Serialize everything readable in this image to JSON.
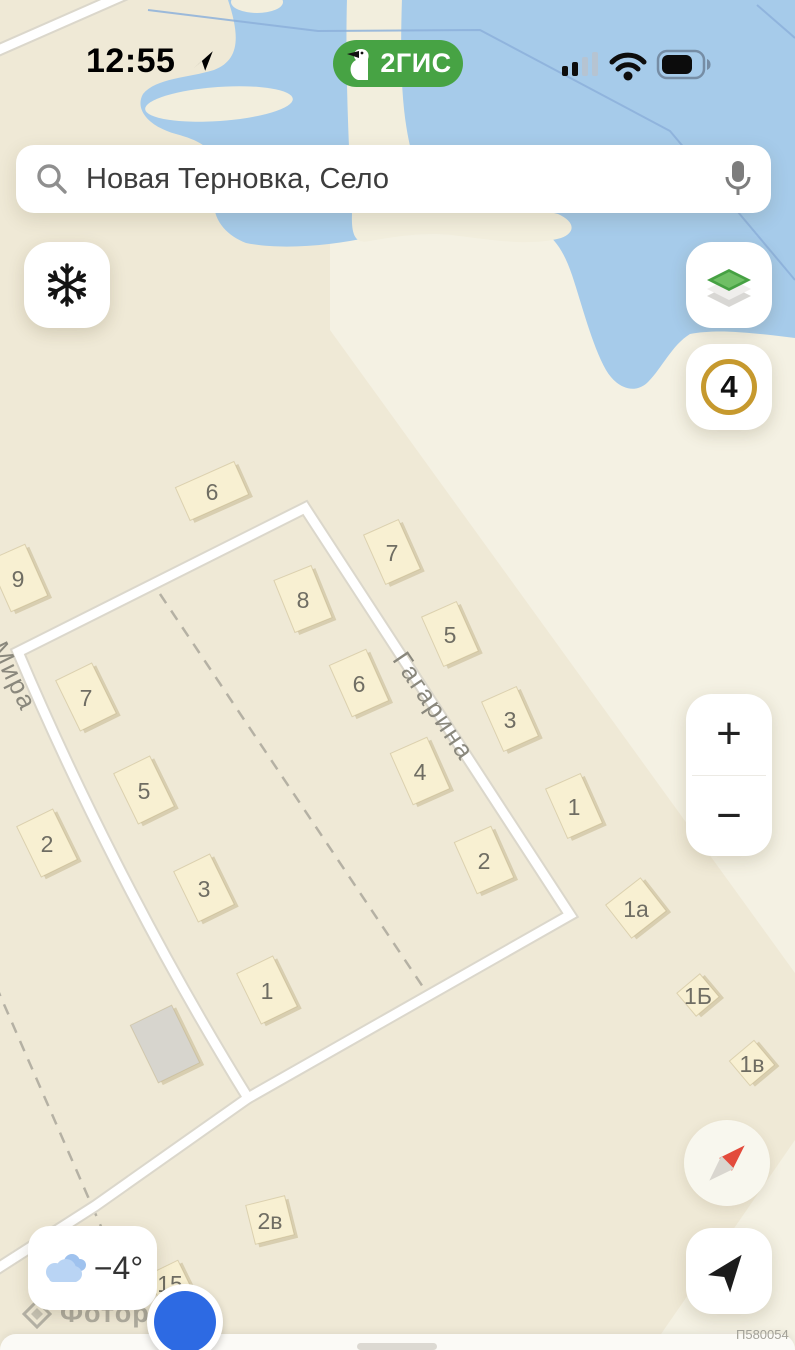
{
  "status_bar": {
    "time": "12:55"
  },
  "branding": {
    "label": "2ГИС"
  },
  "search": {
    "query": "Новая Терновка, Село"
  },
  "map_controls": {
    "floor_badge": "4",
    "zoom_in": "+",
    "zoom_out": "−"
  },
  "weather": {
    "temperature": "−4°"
  },
  "watermark": {
    "brand": "Фоториэлт"
  },
  "footer": {
    "code": "П580054"
  },
  "colors": {
    "brand_green": "#47a344",
    "water": "#a6cbea",
    "land": "#efe9d6",
    "building": "#f8f0d2",
    "floor_ring_gold": "#c6992e",
    "marker_blue": "#2d6ae3"
  },
  "map": {
    "street_labels": [
      {
        "text": "Мира",
        "x": 14,
        "y": 676,
        "angle": 64
      },
      {
        "text": "Гагарина",
        "x": 434,
        "y": 706,
        "angle": 56
      }
    ],
    "buildings": [
      {
        "label": "6",
        "x": 212,
        "y": 491,
        "w": 64,
        "h": 36,
        "a": -24
      },
      {
        "label": "9",
        "x": 18,
        "y": 578,
        "w": 40,
        "h": 56,
        "a": -24
      },
      {
        "label": "7",
        "x": 392,
        "y": 552,
        "w": 38,
        "h": 54,
        "a": -24
      },
      {
        "label": "8",
        "x": 303,
        "y": 599,
        "w": 40,
        "h": 56,
        "a": -22
      },
      {
        "label": "5",
        "x": 450,
        "y": 634,
        "w": 38,
        "h": 54,
        "a": -24
      },
      {
        "label": "7",
        "x": 86,
        "y": 697,
        "w": 40,
        "h": 56,
        "a": -26
      },
      {
        "label": "6",
        "x": 359,
        "y": 683,
        "w": 40,
        "h": 56,
        "a": -24
      },
      {
        "label": "3",
        "x": 510,
        "y": 719,
        "w": 38,
        "h": 54,
        "a": -24
      },
      {
        "label": "4",
        "x": 420,
        "y": 771,
        "w": 40,
        "h": 56,
        "a": -24
      },
      {
        "label": "5",
        "x": 144,
        "y": 790,
        "w": 40,
        "h": 56,
        "a": -26
      },
      {
        "label": "1",
        "x": 574,
        "y": 806,
        "w": 38,
        "h": 54,
        "a": -24
      },
      {
        "label": "2",
        "x": 47,
        "y": 843,
        "w": 40,
        "h": 56,
        "a": -26
      },
      {
        "label": "2",
        "x": 484,
        "y": 860,
        "w": 40,
        "h": 56,
        "a": -24
      },
      {
        "label": "3",
        "x": 204,
        "y": 888,
        "w": 40,
        "h": 56,
        "a": -26
      },
      {
        "label": "1а",
        "x": 636,
        "y": 908,
        "w": 44,
        "h": 42,
        "a": -38
      },
      {
        "label": "1",
        "x": 267,
        "y": 990,
        "w": 40,
        "h": 56,
        "a": -26
      },
      {
        "label": "1Б",
        "x": 698,
        "y": 995,
        "w": 30,
        "h": 30,
        "a": -40
      },
      {
        "label": "",
        "x": 165,
        "y": 1044,
        "w": 46,
        "h": 64,
        "a": -26,
        "fill": "#d7d5ce"
      },
      {
        "label": "1в",
        "x": 752,
        "y": 1063,
        "w": 32,
        "h": 32,
        "a": -40
      },
      {
        "label": "2в",
        "x": 270,
        "y": 1220,
        "w": 40,
        "h": 40,
        "a": -14
      },
      {
        "label": "15",
        "x": 170,
        "y": 1283,
        "w": 34,
        "h": 34,
        "a": -26
      }
    ]
  }
}
